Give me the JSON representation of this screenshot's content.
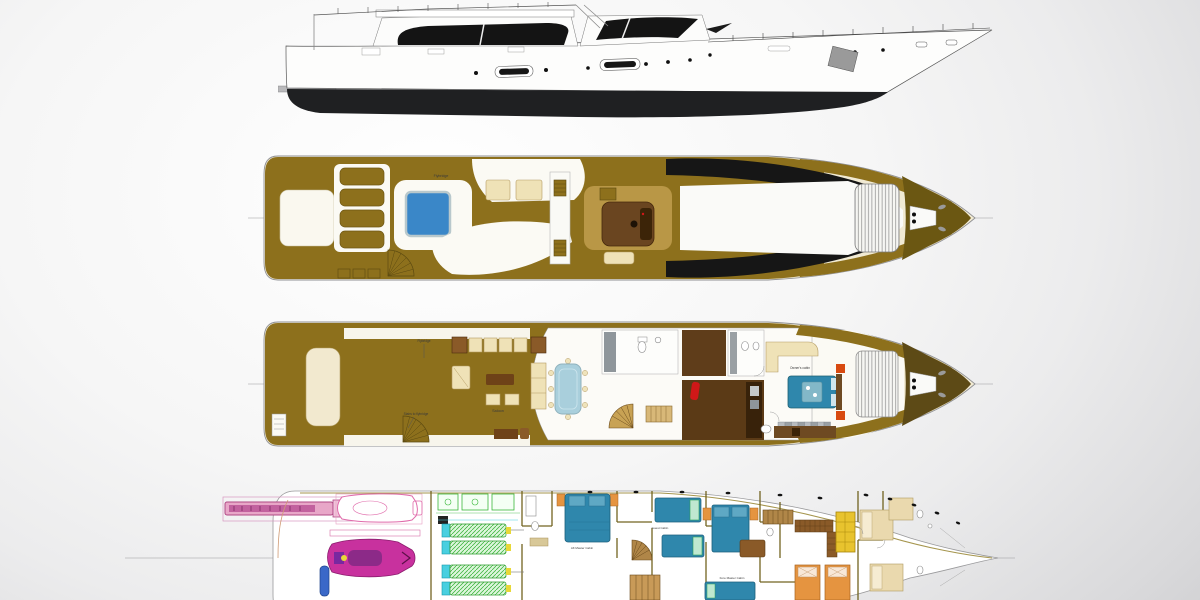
{
  "colors": {
    "hull_black": "#1f2022",
    "deck_gold": "#8d701c",
    "hull_cream": "#f1ead3",
    "furniture_cream": "#efe2b7",
    "wood_brown": "#8a5a28",
    "wood_dark": "#5b3a16",
    "helm_brown": "#6a4520",
    "jacuzzi_blue": "#3a87c8",
    "glass_blue": "#a9cfdc",
    "bed_blue": "#2f87ac",
    "accent_red": "#d01818",
    "accent_orange": "#e07828",
    "tender_pink": "#e06aaa",
    "jetski_magenta": "#c8319e",
    "engine_green": "#35b83a",
    "engine_cyan": "#49cfe0",
    "galley_yellow": "#e8c32e",
    "crew_orange": "#e59440",
    "wall_olive": "#6b5c16",
    "centerline": "#9a9a9c",
    "label_ink": "#3a3a3a"
  },
  "labels": {
    "flybridge_deck": {
      "flybridge": "Flybridge"
    },
    "main_deck": {
      "flybridge_note": "Flybridge",
      "stairs_note": "Stairs to flybridge",
      "saloon": "Saloon",
      "owners_cabin": "Owner's cabin"
    },
    "lower_deck": {
      "aft_master_cabin": "Aft Master Cabin",
      "guest_cabin": "Guest Cabin",
      "fore_master_cabin": "Fore Master Cabin"
    }
  }
}
